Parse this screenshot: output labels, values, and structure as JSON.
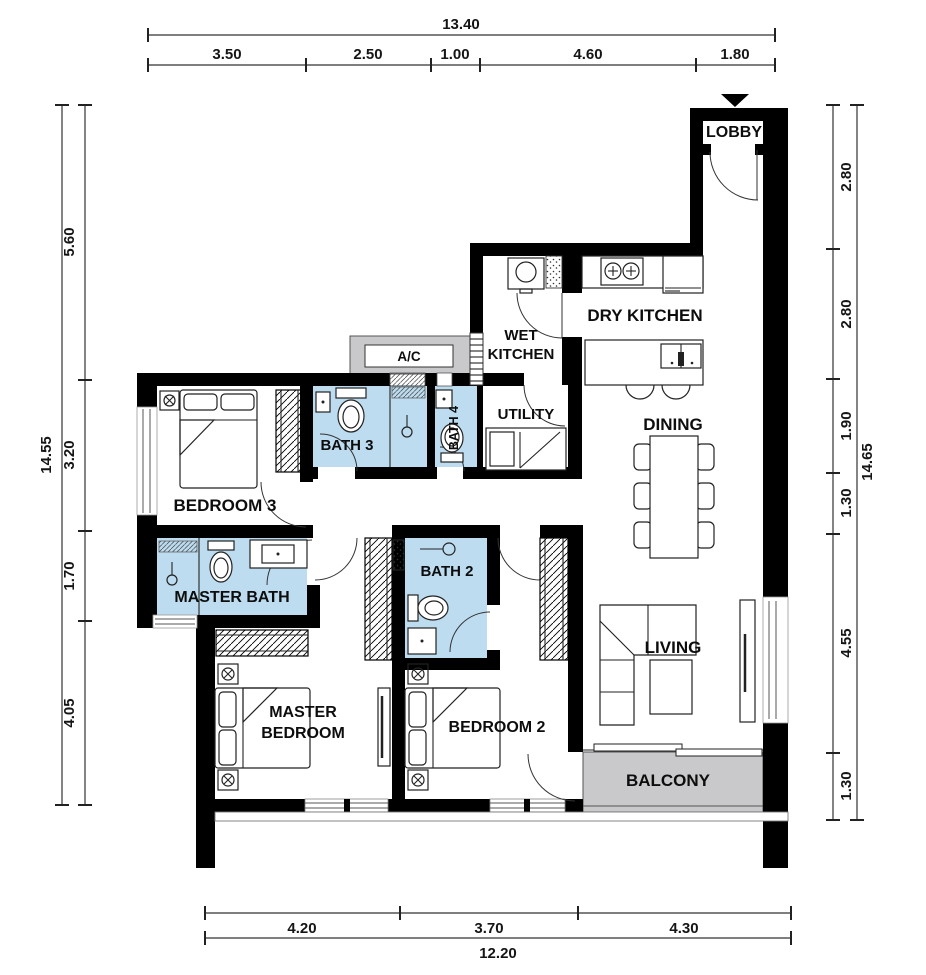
{
  "rooms": {
    "lobby": "LOBBY",
    "dry_kitchen": "DRY KITCHEN",
    "wet_kitchen": [
      "WET",
      "KITCHEN"
    ],
    "utility": "UTILITY",
    "ac_ledge": "A/C",
    "bath3": "BATH 3",
    "bath4": "BATH 4",
    "bedroom3": "BEDROOM 3",
    "master_bath": "MASTER BATH",
    "bath2": "BATH 2",
    "dining": "DINING",
    "living": "LIVING",
    "master_bedroom": [
      "MASTER",
      "BEDROOM"
    ],
    "bedroom2": "BEDROOM 2",
    "balcony": "BALCONY"
  },
  "dims": {
    "top": {
      "total": "13.40",
      "segments": [
        "3.50",
        "2.50",
        "1.00",
        "4.60",
        "1.80"
      ]
    },
    "left": {
      "total": "14.55",
      "segments": [
        "5.60",
        "3.20",
        "1.70",
        "4.05"
      ]
    },
    "right": {
      "total": "14.65",
      "segments": [
        "2.80",
        "2.80",
        "1.90",
        "1.30",
        "4.55",
        "1.30"
      ]
    },
    "bottom": {
      "total": "12.20",
      "segments": [
        "4.20",
        "3.70",
        "4.30"
      ]
    }
  },
  "colors": {
    "wall": "#000000",
    "bath_fill": "#bddcf0",
    "ledge_fill": "#c9c9cb",
    "balcony_fill": "#c9c9cb",
    "dim_line": "#333333"
  }
}
